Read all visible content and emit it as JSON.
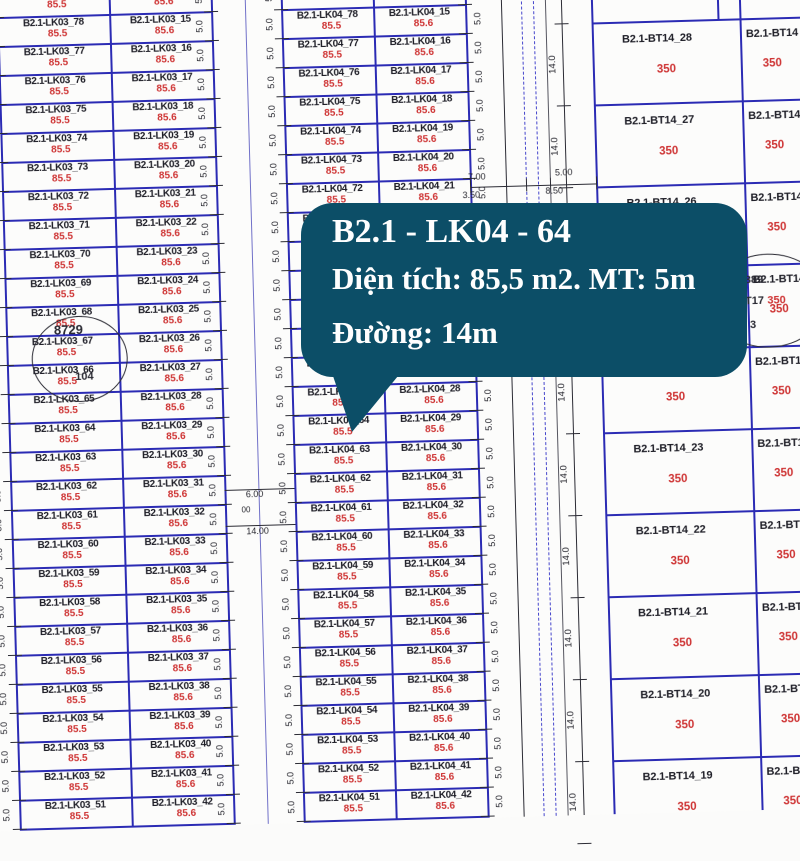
{
  "callout": {
    "title": "B2.1 - LK04 - 64",
    "line2": "Diện tích: 85,5 m2. MT: 5m",
    "line3": "Đường: 14m",
    "bg_color": "#0c4e67",
    "text_color": "#fefefe"
  },
  "blocks": {
    "lk03": {
      "prefix": "B2.1-LK03_",
      "left_numbers": [
        "79",
        "78",
        "77",
        "76",
        "75",
        "74",
        "73",
        "72",
        "71",
        "70",
        "69",
        "68",
        "67",
        "66",
        "65",
        "64",
        "63",
        "62",
        "61",
        "60",
        "59",
        "58",
        "57",
        "56",
        "55",
        "54",
        "53",
        "52",
        "51"
      ],
      "right_numbers": [
        "14",
        "15",
        "16",
        "17",
        "18",
        "19",
        "20",
        "21",
        "22",
        "23",
        "24",
        "25",
        "26",
        "27",
        "28",
        "29",
        "30",
        "31",
        "32",
        "33",
        "34",
        "35",
        "36",
        "37",
        "38",
        "39",
        "40",
        "41",
        "42"
      ],
      "left_area": "85.5",
      "right_area": "85.6"
    },
    "lk04": {
      "prefix": "B2.1-LK04_",
      "left_numbers": [
        "79",
        "78",
        "77",
        "76",
        "75",
        "74",
        "73",
        "72",
        "71",
        "70",
        "69",
        "68",
        "67",
        "66",
        "65",
        "64",
        "63",
        "62",
        "61",
        "60",
        "59",
        "58",
        "57",
        "56",
        "55",
        "54",
        "53",
        "52",
        "51"
      ],
      "right_numbers": [
        "14",
        "15",
        "16",
        "17",
        "18",
        "19",
        "20",
        "21",
        "22",
        "23",
        "24",
        "25",
        "26",
        "27",
        "28",
        "29",
        "30",
        "31",
        "32",
        "33",
        "34",
        "35",
        "36",
        "37",
        "38",
        "39",
        "40",
        "41",
        "42"
      ],
      "left_area": "85.5",
      "right_area": "85.6"
    },
    "bt14": {
      "prefix": "B2.1-BT14_",
      "left_numbers": [
        "28",
        "27",
        "26",
        "25",
        "24",
        "23",
        "22",
        "21",
        "20",
        "19"
      ],
      "left_area": "350",
      "right_label": "B2.1-BT14",
      "right_area": "350"
    }
  },
  "dimensions": {
    "lot_width": "5.0",
    "bt_lot_width": "14.0",
    "road_left": {
      "a": "6.00",
      "b": "00",
      "c": "14.00"
    },
    "road_right": {
      "a": "7.00",
      "b": "5.00",
      "c": "3.50",
      "d": "8.50"
    }
  },
  "circles": {
    "left": {
      "top": "8729",
      "bottom": "104"
    },
    "right": {
      "line1": "889",
      "line2": "-BT17",
      "line2_value": "350",
      "line3": "3"
    }
  },
  "colors": {
    "boundary_blue": "#2b2bb4",
    "dash_blue": "#4545cc",
    "ink_black": "#2a2a33",
    "area_red": "#ce3333"
  }
}
